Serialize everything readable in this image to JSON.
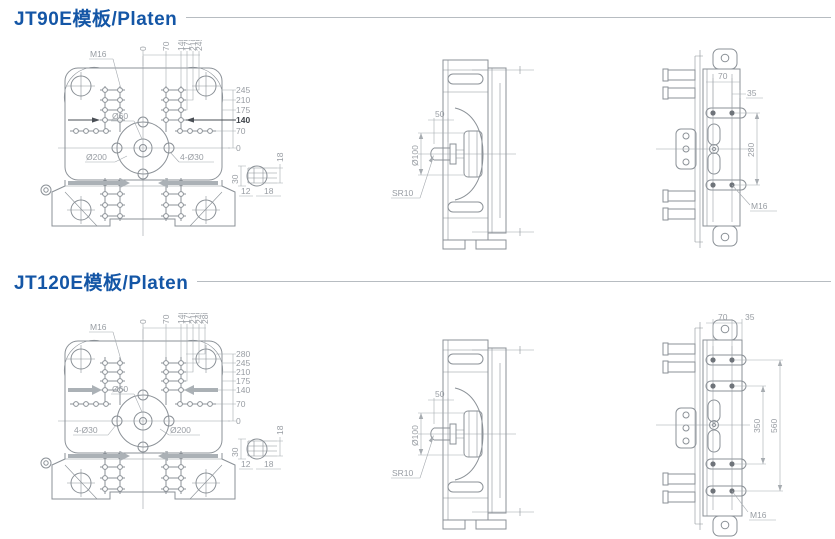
{
  "colors": {
    "accent": "#1456a6",
    "line": "#8b9197",
    "dim_text": "#989da3",
    "emphasis": "#3f444a",
    "rule": "#b7bcc1",
    "arrow": "#abb1b6"
  },
  "sections": [
    {
      "title": "JT90E模板/Platen",
      "front": {
        "thread_label": "M16",
        "center_hole_label": "Ø60",
        "bolt_circle_label": "Ø200",
        "corner_holes_label": "4-Ø30",
        "top_ticks": [
          "0",
          "70",
          "140",
          "175",
          "210",
          "245"
        ],
        "right_ticks": [
          "245",
          "210",
          "175",
          "140",
          "70",
          "0"
        ],
        "detail": {
          "d1": "30",
          "d2": "18",
          "d3": "12",
          "d4": "18"
        }
      },
      "side": {
        "offset_label": "50",
        "rod_label": "Ø100",
        "tip_label": "SR10"
      },
      "rear": {
        "span_label": "70",
        "edge_label": "35",
        "height_label": "280",
        "thread_label": "M16"
      }
    },
    {
      "title": "JT120E模板/Platen",
      "front": {
        "thread_label": "M16",
        "center_hole_label": "Ø60",
        "bolt_circle_label": "Ø200",
        "corner_holes_label": "4-Ø30",
        "top_ticks": [
          "0",
          "70",
          "140",
          "175",
          "210",
          "245",
          "280"
        ],
        "right_ticks": [
          "280",
          "245",
          "210",
          "175",
          "140",
          "70",
          "0"
        ],
        "detail": {
          "d1": "30",
          "d2": "18",
          "d3": "12",
          "d4": "18"
        }
      },
      "side": {
        "offset_label": "50",
        "rod_label": "Ø100",
        "tip_label": "SR10"
      },
      "rear": {
        "span_label": "70",
        "edge_label": "35",
        "inner_height_label": "350",
        "outer_height_label": "560",
        "thread_label": "M16"
      }
    }
  ]
}
